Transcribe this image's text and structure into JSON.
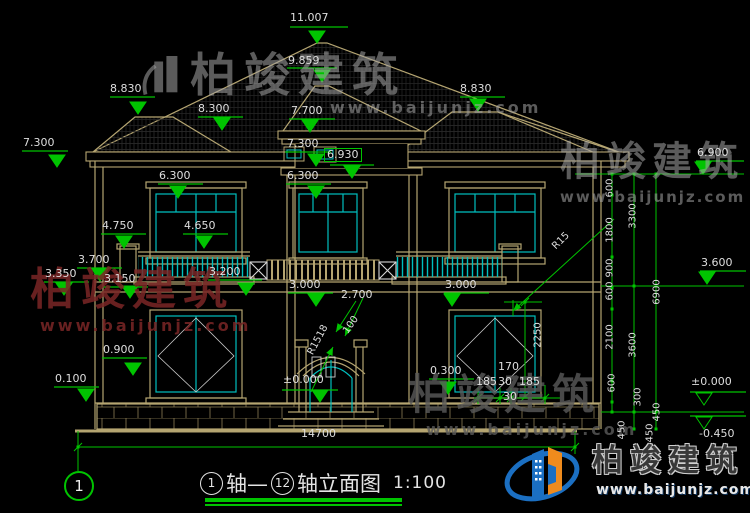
{
  "brand": {
    "name": "柏竣建筑",
    "url": "www.baijunjz.com"
  },
  "drawing": {
    "axis_bubble": "1",
    "title_axis_start": "1",
    "title_mid": "轴—",
    "title_axis_end": "12",
    "title_name": "轴立面图",
    "title_scale": "1:100"
  },
  "labels": [
    {
      "t": "11.007",
      "x": 290,
      "y": 12
    },
    {
      "t": "9.859",
      "x": 288,
      "y": 55
    },
    {
      "t": "8.830",
      "x": 110,
      "y": 83
    },
    {
      "t": "8.830",
      "x": 460,
      "y": 83
    },
    {
      "t": "8.300",
      "x": 198,
      "y": 103
    },
    {
      "t": "7.700",
      "x": 291,
      "y": 105
    },
    {
      "t": "7.300",
      "x": 23,
      "y": 137
    },
    {
      "t": "7.300",
      "x": 287,
      "y": 138
    },
    {
      "t": "6.930",
      "x": 324,
      "y": 148,
      "box": true
    },
    {
      "t": "6.900",
      "x": 697,
      "y": 147
    },
    {
      "t": "6.300",
      "x": 159,
      "y": 170
    },
    {
      "t": "6.300",
      "x": 287,
      "y": 170
    },
    {
      "t": "4.750",
      "x": 102,
      "y": 220
    },
    {
      "t": "4.650",
      "x": 184,
      "y": 220
    },
    {
      "t": "3.700",
      "x": 78,
      "y": 254
    },
    {
      "t": "3.350",
      "x": 45,
      "y": 268
    },
    {
      "t": "3.150",
      "x": 104,
      "y": 273
    },
    {
      "t": "3.200",
      "x": 209,
      "y": 266
    },
    {
      "t": "3.000",
      "x": 289,
      "y": 279
    },
    {
      "t": "3.000",
      "x": 445,
      "y": 279
    },
    {
      "t": "2.700",
      "x": 341,
      "y": 289
    },
    {
      "t": "3.600",
      "x": 701,
      "y": 257
    },
    {
      "t": "0.900",
      "x": 103,
      "y": 344
    },
    {
      "t": "0.100",
      "x": 55,
      "y": 373
    },
    {
      "t": "±0.000",
      "x": 283,
      "y": 374
    },
    {
      "t": "0.300",
      "x": 430,
      "y": 365
    },
    {
      "t": "170",
      "x": 498,
      "y": 361
    },
    {
      "t": "185",
      "x": 476,
      "y": 376
    },
    {
      "t": "30",
      "x": 498,
      "y": 376
    },
    {
      "t": "185",
      "x": 519,
      "y": 376
    },
    {
      "t": "30",
      "x": 503,
      "y": 391
    },
    {
      "t": "±0.000",
      "x": 691,
      "y": 376
    },
    {
      "t": "-0.450",
      "x": 699,
      "y": 428
    },
    {
      "t": "14700",
      "x": 301,
      "y": 428
    },
    {
      "t": "2250",
      "x": 538,
      "y": 335,
      "r": -90
    },
    {
      "t": "R1518",
      "x": 318,
      "y": 340,
      "r": -62
    },
    {
      "t": "100",
      "x": 351,
      "y": 325,
      "r": -55
    },
    {
      "t": "R15",
      "x": 561,
      "y": 241,
      "r": -45
    },
    {
      "t": "600",
      "x": 610,
      "y": 188,
      "r": -90
    },
    {
      "t": "1800",
      "x": 610,
      "y": 230,
      "r": -90
    },
    {
      "t": "3300",
      "x": 633,
      "y": 216,
      "r": -90
    },
    {
      "t": "900",
      "x": 610,
      "y": 268,
      "r": -90
    },
    {
      "t": "600",
      "x": 610,
      "y": 291,
      "r": -90
    },
    {
      "t": "6900",
      "x": 657,
      "y": 292,
      "r": -90
    },
    {
      "t": "2100",
      "x": 610,
      "y": 337,
      "r": -90
    },
    {
      "t": "3600",
      "x": 633,
      "y": 345,
      "r": -90
    },
    {
      "t": "600",
      "x": 612,
      "y": 383,
      "r": -90
    },
    {
      "t": "300",
      "x": 638,
      "y": 397,
      "r": -90
    },
    {
      "t": "450",
      "x": 657,
      "y": 412,
      "r": -90
    },
    {
      "t": "450",
      "x": 622,
      "y": 430,
      "r": -90
    },
    {
      "t": "450",
      "x": 650,
      "y": 433,
      "r": -90
    }
  ],
  "colors": {
    "line_tan": "#b5a571",
    "line_cyan": "#00bfbf",
    "dim_green": "#00c400",
    "text": "#dedede",
    "logo_blue": "#1b6fc2",
    "logo_orange": "#ef8b1d",
    "wm_red": "#7a2626"
  }
}
